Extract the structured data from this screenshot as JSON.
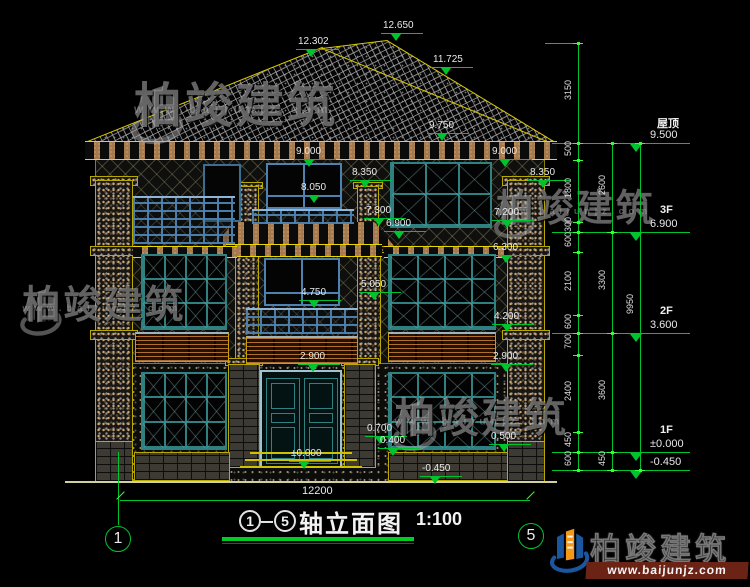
{
  "colors": {
    "dim_green": "#00c42e",
    "tick_green": "#35ff35",
    "outline_yellow": "#d8c800",
    "text_white": "#e8e8e8",
    "frame_teal": "#2f8080",
    "frame_blue": "#4d82b0",
    "wood_brown": "#8a5a2e",
    "brand_blue": "#1a57a0",
    "brand_orange": "#f2991c",
    "banner_red": "#6b2315"
  },
  "facade_labels": [
    {
      "text": "12.302",
      "x": 298,
      "y": 36
    },
    {
      "text": "12.650",
      "x": 383,
      "y": 20
    },
    {
      "text": "11.725",
      "x": 433,
      "y": 54
    },
    {
      "text": "9.750",
      "x": 429,
      "y": 120
    },
    {
      "text": "9.000",
      "x": 296,
      "y": 146
    },
    {
      "text": "9.000",
      "x": 492,
      "y": 146
    },
    {
      "text": "8.350",
      "x": 352,
      "y": 167
    },
    {
      "text": "8.350",
      "x": 530,
      "y": 167
    },
    {
      "text": "8.050",
      "x": 301,
      "y": 182
    },
    {
      "text": "7.300",
      "x": 366,
      "y": 205
    },
    {
      "text": "7.200",
      "x": 494,
      "y": 207
    },
    {
      "text": "6.900",
      "x": 386,
      "y": 218
    },
    {
      "text": "6.300",
      "x": 493,
      "y": 242
    },
    {
      "text": "5.050",
      "x": 361,
      "y": 279
    },
    {
      "text": "4.750",
      "x": 301,
      "y": 287
    },
    {
      "text": "4.200",
      "x": 494,
      "y": 311
    },
    {
      "text": "2.900",
      "x": 300,
      "y": 351
    },
    {
      "text": "2.900",
      "x": 493,
      "y": 351
    },
    {
      "text": "0.700",
      "x": 367,
      "y": 423
    },
    {
      "text": "0.400",
      "x": 380,
      "y": 435
    },
    {
      "text": "0.500",
      "x": 491,
      "y": 431
    },
    {
      "text": "±0.000",
      "x": 291,
      "y": 448
    },
    {
      "text": "-0.450",
      "x": 422,
      "y": 463
    }
  ],
  "right_levels": [
    {
      "name": "屋顶",
      "value": "9.500",
      "y": 143
    },
    {
      "name": "3F",
      "value": "6.900",
      "y": 232
    },
    {
      "name": "2F",
      "value": "3.600",
      "y": 333
    },
    {
      "name": "1F",
      "value": "±0.000",
      "y": 452
    },
    {
      "name": "",
      "value": "-0.450",
      "y": 470
    }
  ],
  "dim_chains": [
    {
      "x": 578,
      "ticks": [
        43,
        143
      ],
      "labels": [
        "3150"
      ]
    },
    {
      "x": 578,
      "ticks": [
        143,
        160,
        222,
        232,
        252,
        315,
        333,
        355,
        432,
        452,
        470
      ],
      "labels": [
        "500",
        "1800",
        "300",
        "600",
        "2100",
        "600",
        "700",
        "2400",
        "450",
        "600"
      ]
    },
    {
      "x": 612,
      "ticks": [
        143,
        232,
        333,
        452,
        470
      ],
      "labels": [
        "2600",
        "3300",
        "3600",
        "450"
      ]
    },
    {
      "x": 640,
      "ticks": [
        143,
        470
      ],
      "labels": [
        "9950"
      ]
    }
  ],
  "bottom_dim": {
    "text": "12200",
    "x1": 120,
    "x2": 530,
    "y": 500,
    "label_x": 302,
    "label_y": 486
  },
  "axis_bubbles": [
    {
      "label": "1",
      "cx": 118,
      "cy": 539
    },
    {
      "label": "5",
      "cx": 531,
      "cy": 536
    }
  ],
  "title": {
    "axis_from": "1",
    "axis_to": "5",
    "text": "轴立面图",
    "scale": "1:100"
  },
  "watermarks": [
    {
      "x": 126,
      "y": 82,
      "s": 1.0,
      "text": "柏竣建筑",
      "url": "www.baijunjz.com"
    },
    {
      "x": 16,
      "y": 286,
      "s": 0.8,
      "text": "柏竣建筑",
      "url": "www.baijunjz.com"
    },
    {
      "x": 490,
      "y": 190,
      "s": 0.78,
      "text": "柏竣建筑",
      "url": "www.baijunjz.com"
    },
    {
      "x": 388,
      "y": 398,
      "s": 0.85,
      "text": "柏竣建筑",
      "url": "www.baijunjz.com"
    }
  ],
  "brand": {
    "name": "柏竣建筑",
    "url": "www.baijunjz.com"
  }
}
